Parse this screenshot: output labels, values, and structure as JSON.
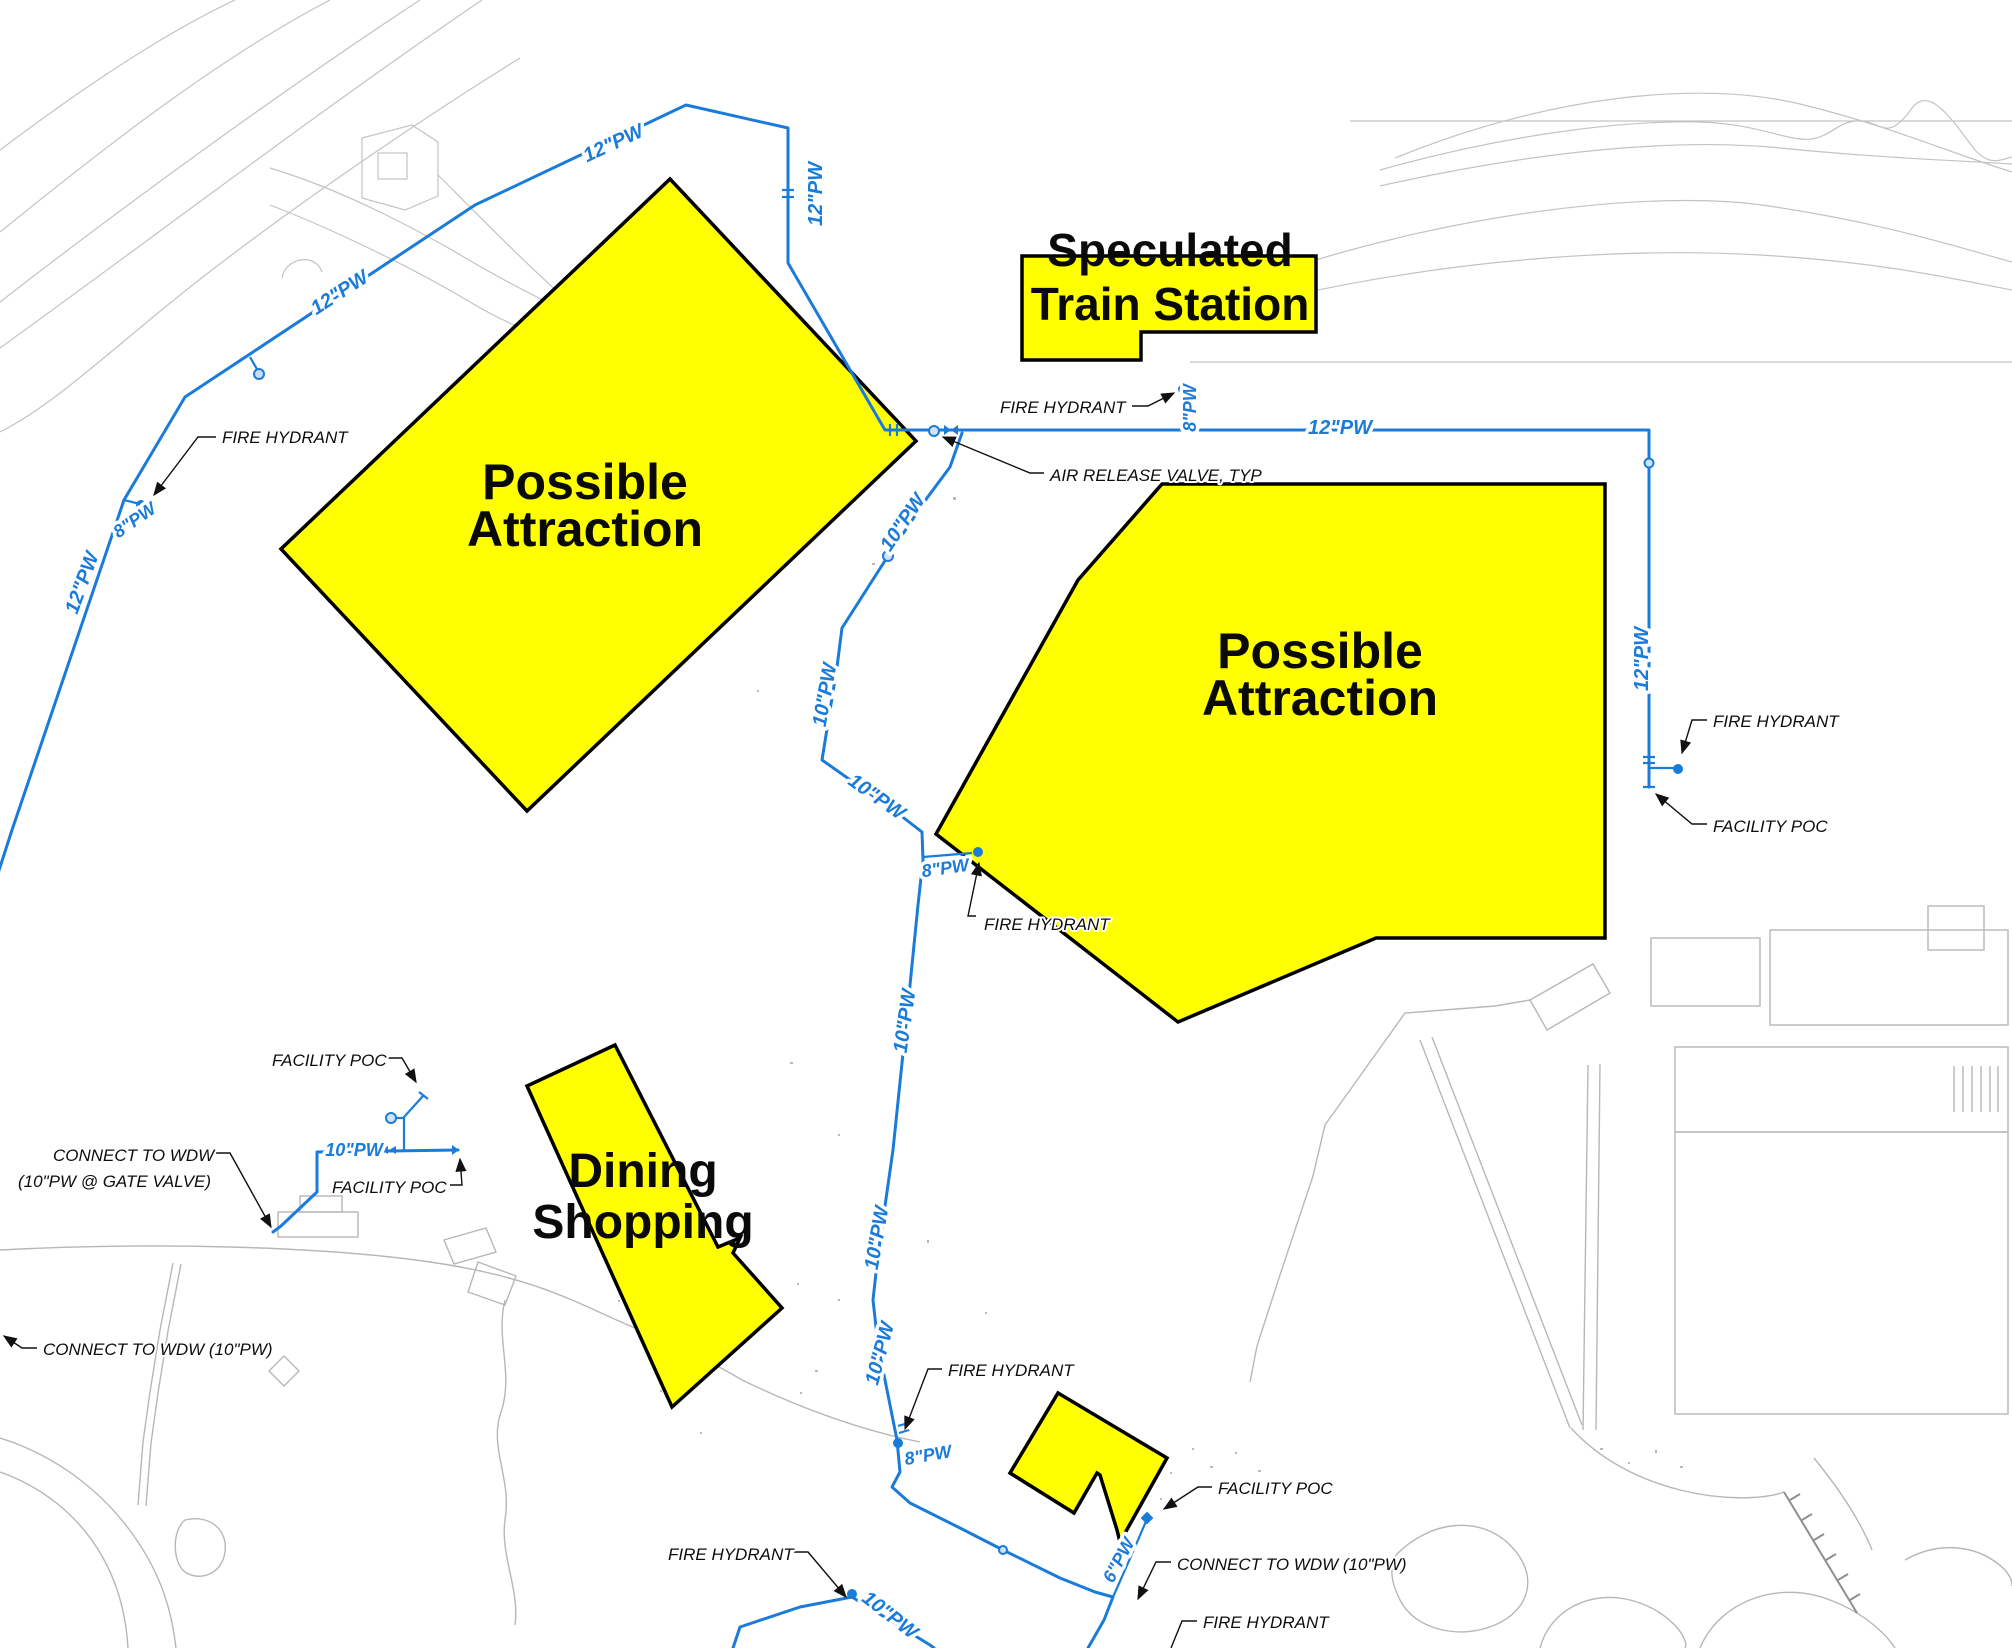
{
  "drawing_type": "site-utility-plan",
  "colors": {
    "pipe_blue": "#1a7bd9",
    "highlight_yellow": "#ffff00",
    "linework_gray": "#b7b7b7",
    "text_black": "#0d0d0d"
  },
  "areas": {
    "train_station": {
      "line1": "Speculated",
      "line2": "Train Station"
    },
    "attraction_nw": {
      "line1": "Possible",
      "line2": "Attraction"
    },
    "attraction_e": {
      "line1": "Possible",
      "line2": "Attraction"
    },
    "dining": {
      "line1": "Dining",
      "line2": "Shopping"
    }
  },
  "pipes": {
    "labels": [
      {
        "text": "12\"PW"
      },
      {
        "text": "12\"PW"
      },
      {
        "text": "12\"PW"
      },
      {
        "text": "12\"PW"
      },
      {
        "text": "12\"PW"
      },
      {
        "text": "12\"PW"
      },
      {
        "text": "10\"PW"
      },
      {
        "text": "10\"PW"
      },
      {
        "text": "10\"PW"
      },
      {
        "text": "10\"PW"
      },
      {
        "text": "10\"PW"
      },
      {
        "text": "10\"PW"
      },
      {
        "text": "10\"PW"
      },
      {
        "text": "10\"PW"
      },
      {
        "text": "8\"PW"
      },
      {
        "text": "8\"PW"
      },
      {
        "text": "8\"PW"
      },
      {
        "text": "8\"PW"
      },
      {
        "text": "6\"PW"
      }
    ]
  },
  "notes": [
    {
      "text": "FIRE HYDRANT"
    },
    {
      "text": "FIRE HYDRANT"
    },
    {
      "text": "AIR RELEASE VALVE, TYP"
    },
    {
      "text": "FIRE HYDRANT"
    },
    {
      "text": "FACILITY POC"
    },
    {
      "text": "FIRE HYDRANT"
    },
    {
      "text": "FACILITY POC"
    },
    {
      "text": "CONNECT TO WDW"
    },
    {
      "text": "(10\"PW @ GATE VALVE)"
    },
    {
      "text": "FACILITY POC"
    },
    {
      "text": "CONNECT TO WDW (10\"PW)"
    },
    {
      "text": "FIRE HYDRANT"
    },
    {
      "text": "FIRE HYDRANT"
    },
    {
      "text": "FACILITY POC"
    },
    {
      "text": "CONNECT TO WDW (10\"PW)"
    },
    {
      "text": "FIRE HYDRANT"
    }
  ]
}
